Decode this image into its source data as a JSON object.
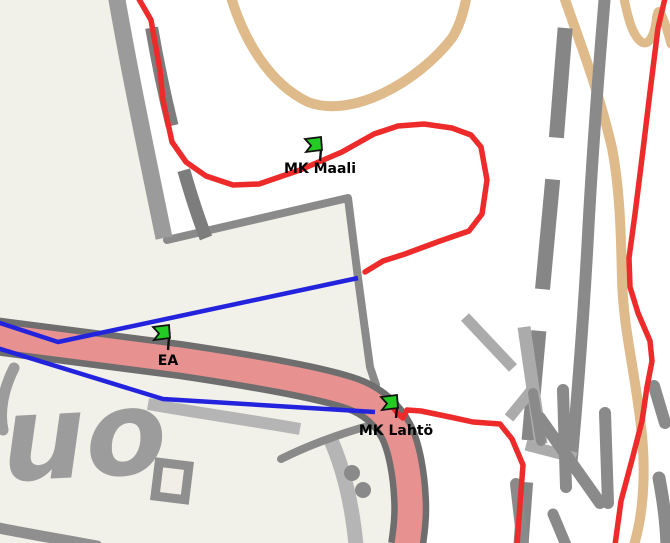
{
  "map": {
    "kind": "orienteering-course-map",
    "markers": [
      {
        "id": "mk-maali",
        "label": "MK Maali"
      },
      {
        "id": "ea",
        "label": "EA"
      },
      {
        "id": "mk-lahto",
        "label": "MK Lahtö"
      }
    ],
    "place_label": "uo",
    "colors": {
      "course_red": "#ee2b2b",
      "leg_blue": "#2323de",
      "flag_green": "#22cc22",
      "road_pink": "#e89191",
      "road_casing_gray": "#6e6e6e",
      "road_gray": "#9b9b9b",
      "dashed_road_gray": "#7d7d7d",
      "path_tan": "#dfba8a",
      "terrain_beige": "#f2f1e9",
      "place_label_gray": "#9c9c9c"
    }
  }
}
